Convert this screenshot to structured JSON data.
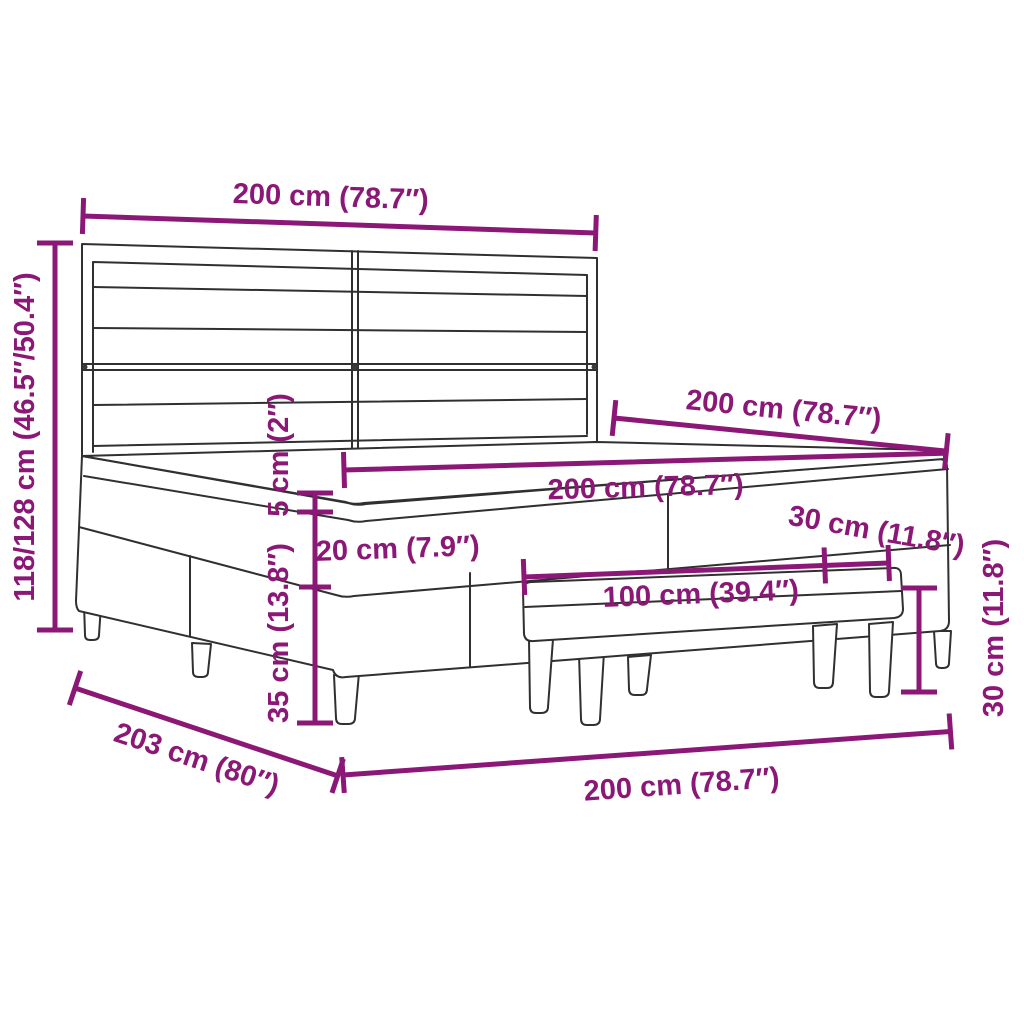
{
  "diagram": {
    "type": "product-dimension-diagram",
    "product": "box-spring-bed-with-headboard-topper-and-bench",
    "colors": {
      "accent": "#8B1876",
      "outline": "#303030",
      "background": "#FFFFFF"
    },
    "labels": {
      "headboard_width": "200 cm (78.7″)",
      "overall_height": "118/128 cm (46.5″/50.4″)",
      "bed_length": "200 cm (78.7″)",
      "mattress_width": "200 cm (78.7″)",
      "topper_thickness": "5 cm (2″)",
      "mattress_thickness": "20 cm (7.9″)",
      "base_with_legs_height": "35 cm (13.8″)",
      "bench_length": "100 cm (39.4″)",
      "bench_depth": "30 cm (11.8″)",
      "bench_height": "30 cm (11.8″)",
      "overall_length": "203 cm (80″)",
      "frame_width": "200 cm (78.7″)"
    }
  }
}
